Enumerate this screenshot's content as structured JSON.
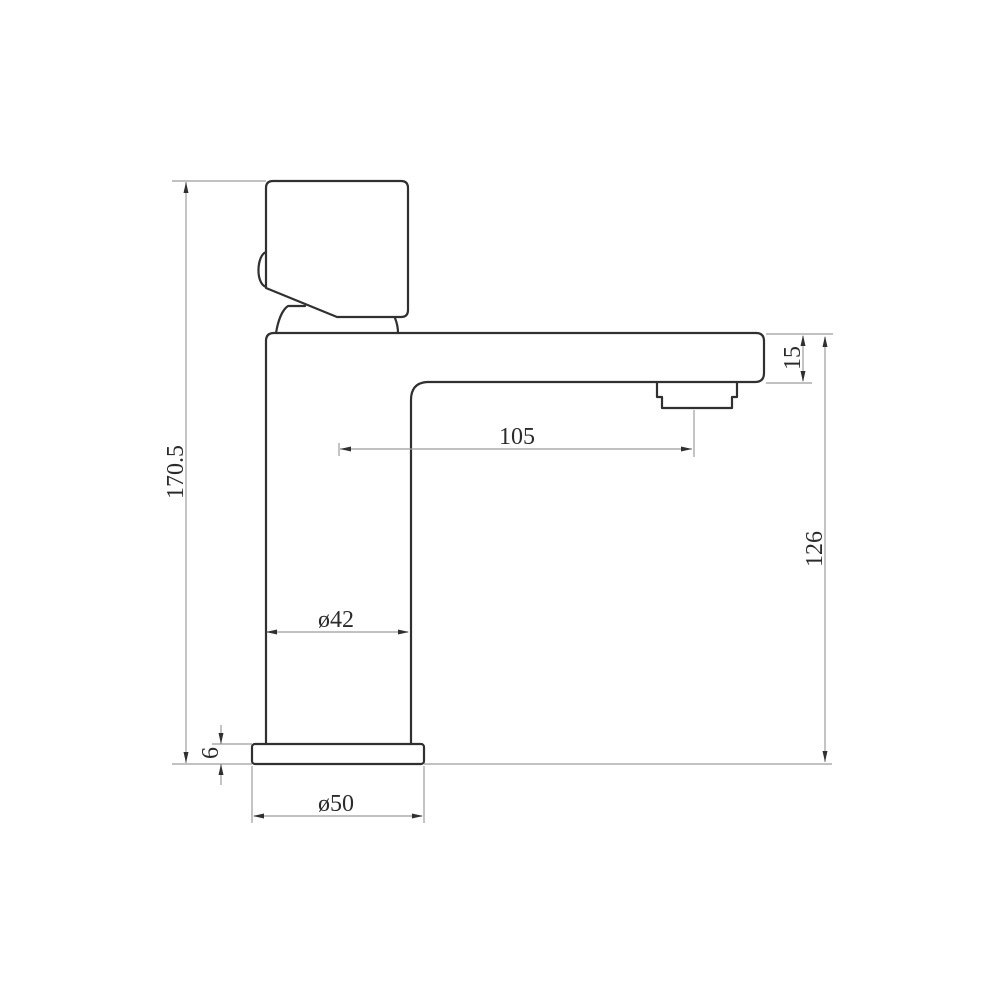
{
  "drawing": {
    "kind": "technical-dimension-drawing",
    "subject": "single-lever basin faucet, side elevation",
    "colors": {
      "background": "#ffffff",
      "part_outline": "#303030",
      "dimension_lines": "#9c9c9c",
      "dimension_text": "#2b2b2b"
    },
    "labels": {
      "total_height": "170.5",
      "base_height": "6",
      "body_diameter": "ø42",
      "base_diameter": "ø50",
      "spout_reach": "105",
      "spout_tip_height": "15",
      "spout_underside_height": "126"
    }
  }
}
